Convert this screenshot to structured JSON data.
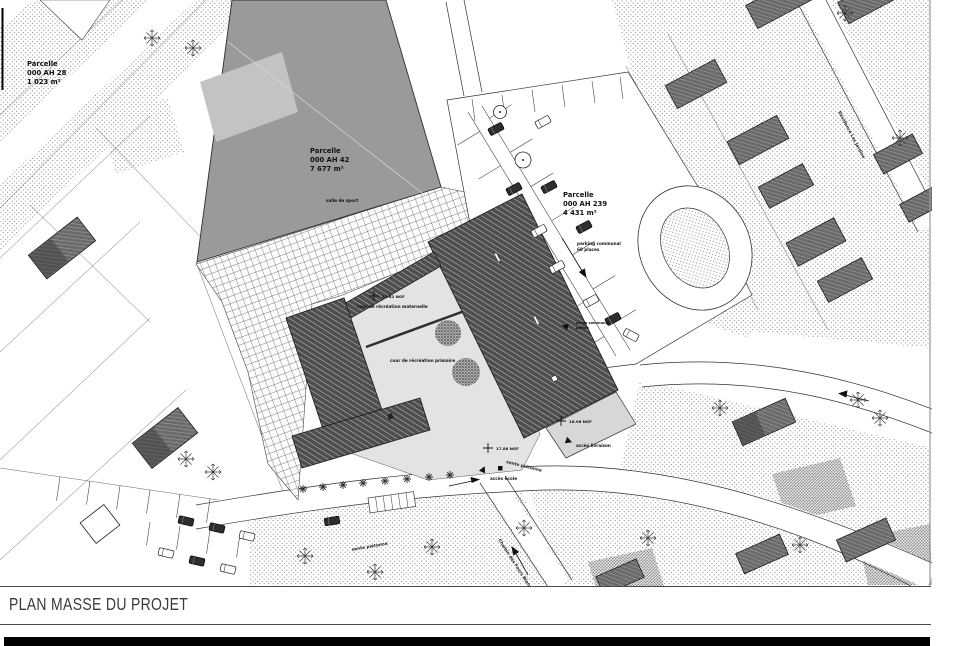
{
  "colors": {
    "paper": "#ffffff",
    "ink": "#1a1a1a",
    "roof_dark": "#4e4e4e",
    "gym_gray": "#9a9a9a",
    "courtyard_gray": "#e3e3e3",
    "black_bar": "#000000"
  },
  "plan": {
    "parcels": [
      {
        "name": "Parcelle",
        "code": "000 AH 28",
        "area": "1 023 m²"
      },
      {
        "name": "Parcelle",
        "code": "000 AH 42",
        "area": "7 677 m²"
      },
      {
        "name": "Parcelle",
        "code": "000 AH 239",
        "area": "4 431 m²"
      }
    ],
    "gym_label": "salle de sport",
    "courtyards": {
      "maternelle": "cour de récréation maternelle",
      "primaire": "cour de récréation primaire"
    },
    "parking": {
      "line1": "parking communal",
      "line2": "60 places"
    },
    "access": {
      "delivery": "accès livraison",
      "school": "accès école",
      "communal_line1": "accès communal",
      "communal_line2": "piéton"
    },
    "streets": {
      "path_sw": "sente piétonne",
      "path_se": "sente piétonne",
      "south": "Chemin des Fours Blancs",
      "east": "Résidence Les Jardins"
    },
    "levels": [
      {
        "label": "21.42 NGF"
      },
      {
        "label": "17.88 NGF"
      },
      {
        "label": "16.98 NGF"
      }
    ]
  },
  "title_block": {
    "title": "PLAN MASSE DU PROJET"
  }
}
